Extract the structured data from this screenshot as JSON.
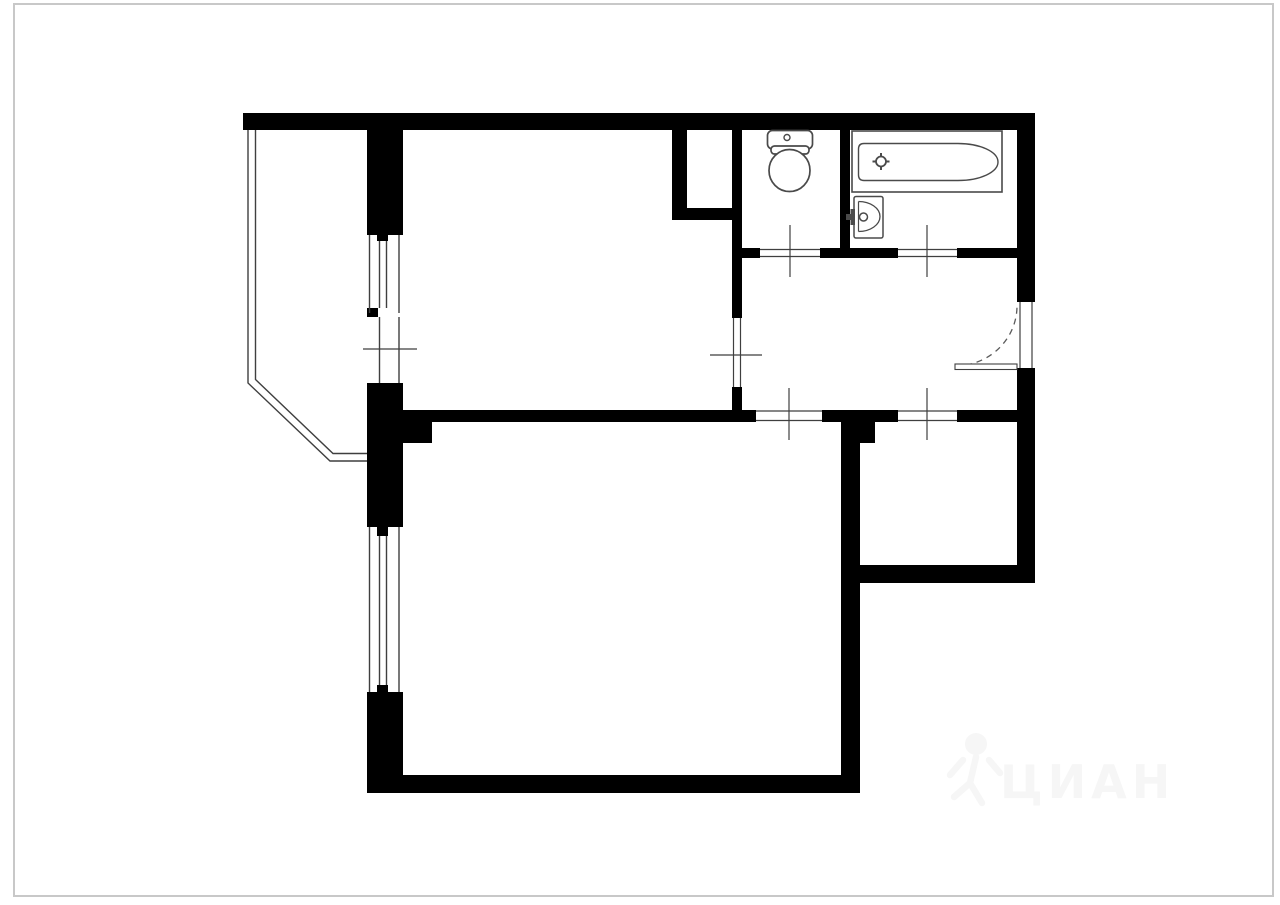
{
  "watermark": {
    "text": "ЦИАН",
    "color": "#f6f6f6"
  },
  "colors": {
    "wall": "#000000",
    "thin": "#3f3f3f",
    "fixture": "#4a4a4a",
    "arc": "#5a5a5a",
    "border": "#c8c8c8",
    "watermark": "#f6f6f6",
    "background": "#ffffff"
  },
  "plan": {
    "walls": [
      [
        243,
        113,
        792,
        17
      ],
      [
        1017,
        130,
        18,
        172
      ],
      [
        1017,
        368,
        18,
        215
      ],
      [
        841,
        565,
        194,
        18
      ],
      [
        841,
        412,
        34,
        31
      ],
      [
        841,
        443,
        19,
        350
      ],
      [
        367,
        775,
        493,
        18
      ],
      [
        367,
        129,
        36,
        106
      ],
      [
        367,
        383,
        36,
        144
      ],
      [
        367,
        692,
        36,
        101
      ],
      [
        377,
        235,
        11,
        6
      ],
      [
        367,
        308,
        11,
        9
      ],
      [
        377,
        527,
        11,
        9
      ],
      [
        377,
        685,
        11,
        8
      ],
      [
        403,
        412,
        29,
        31
      ],
      [
        403,
        410,
        353,
        12
      ],
      [
        822,
        410,
        76,
        12
      ],
      [
        957,
        410,
        78,
        12
      ],
      [
        732,
        130,
        10,
        188
      ],
      [
        732,
        387,
        10,
        35
      ],
      [
        672,
        130,
        15,
        90
      ],
      [
        672,
        208,
        70,
        12
      ],
      [
        840,
        130,
        10,
        128
      ],
      [
        732,
        248,
        28,
        10
      ],
      [
        820,
        248,
        78,
        10
      ],
      [
        957,
        248,
        60,
        10
      ]
    ],
    "opening_lines": [
      [
        760,
        249.5,
        820,
        249.5
      ],
      [
        760,
        256.5,
        820,
        256.5
      ],
      [
        898,
        249.5,
        957,
        249.5
      ],
      [
        898,
        256.5,
        957,
        256.5
      ],
      [
        756,
        411,
        822,
        411
      ],
      [
        756,
        420.5,
        822,
        420.5
      ],
      [
        898,
        411,
        957,
        411
      ],
      [
        898,
        420.5,
        957,
        420.5
      ],
      [
        733.5,
        318,
        733.5,
        387
      ],
      [
        740.5,
        318,
        740.5,
        387
      ],
      [
        1020,
        302,
        1020,
        368
      ],
      [
        1032,
        302,
        1032,
        368
      ],
      [
        790,
        225,
        790,
        277
      ],
      [
        927,
        225,
        927,
        277
      ],
      [
        789,
        388,
        789,
        440
      ],
      [
        927,
        388,
        927,
        440
      ],
      [
        710,
        355,
        762,
        355
      ],
      [
        363,
        349,
        417,
        349
      ]
    ],
    "window_lines": [
      [
        369.5,
        235,
        369.5,
        313
      ],
      [
        379.5,
        241,
        379.5,
        308
      ],
      [
        386.5,
        241,
        386.5,
        308
      ],
      [
        399,
        235,
        399,
        313
      ],
      [
        379.5,
        317,
        379.5,
        383
      ],
      [
        399,
        317,
        399,
        383
      ],
      [
        369.5,
        527,
        369.5,
        692
      ],
      [
        379.5,
        536,
        379.5,
        685
      ],
      [
        386.5,
        536,
        386.5,
        685
      ],
      [
        399,
        527,
        399,
        692
      ]
    ],
    "balcony": [
      "248,130 248,383 330,461 367,461",
      "255.5,130 255.5,379.5 333,453.5 367,453.5"
    ],
    "shapes": [
      {
        "layer": "frame-border",
        "type": "rect",
        "x": 14,
        "y": 4,
        "w": 1259,
        "h": 892,
        "fill": "none",
        "stroke": "border",
        "sw": 2
      },
      {
        "layer": "entry-door",
        "type": "path",
        "d": "M 955 366 A 62 60 0 0 0 1017 306",
        "fill": "none",
        "stroke": "arc",
        "sw": 1.3,
        "dash": "6 5"
      },
      {
        "layer": "entry-door",
        "type": "rect",
        "x": 955,
        "y": 364,
        "w": 62,
        "h": 5.5,
        "fill": "#ffffff",
        "stroke": "thin",
        "sw": 1.1
      },
      {
        "layer": "toilet-icon",
        "type": "rect",
        "x": 767.5,
        "y": 130.5,
        "w": 45,
        "h": 18.5,
        "rx": 5,
        "fill": "#ffffff",
        "stroke": "fixture",
        "sw": 1.7
      },
      {
        "layer": "toilet-icon",
        "type": "circle",
        "cx": 787,
        "cy": 137.5,
        "r": 3,
        "fill": "#ffffff",
        "stroke": "fixture",
        "sw": 1.4
      },
      {
        "layer": "toilet-icon",
        "type": "rect",
        "x": 771,
        "y": 146,
        "w": 38,
        "h": 8,
        "rx": 3.5,
        "fill": "#ffffff",
        "stroke": "fixture",
        "sw": 1.7
      },
      {
        "layer": "toilet-icon",
        "type": "ellipse",
        "cx": 789.5,
        "cy": 170.5,
        "rx": 20.5,
        "ry": 21,
        "fill": "#ffffff",
        "stroke": "fixture",
        "sw": 1.7
      },
      {
        "layer": "bathtub-icon",
        "type": "rect",
        "x": 852,
        "y": 131,
        "w": 150,
        "h": 61,
        "fill": "#ffffff",
        "stroke": "fixture",
        "sw": 1.6
      },
      {
        "layer": "bathtub-icon",
        "type": "path",
        "d": "M 864 143.5 H 958 A 40 18.5 0 0 1 958 180.5 H 864 Q 858.5 180.5 858.5 175 V 149 Q 858.5 143.5 864 143.5 Z",
        "fill": "#ffffff",
        "stroke": "fixture",
        "sw": 1.4
      },
      {
        "layer": "bathtub-icon",
        "type": "circle",
        "cx": 881,
        "cy": 161.5,
        "r": 5,
        "fill": "#ffffff",
        "stroke": "fixture",
        "sw": 1.8
      },
      {
        "layer": "bathtub-icon",
        "type": "line",
        "x1": 881,
        "y1": 153,
        "x2": 881,
        "y2": 157,
        "stroke": "fixture",
        "sw": 2
      },
      {
        "layer": "bathtub-icon",
        "type": "line",
        "x1": 881,
        "y1": 166,
        "x2": 881,
        "y2": 170,
        "stroke": "fixture",
        "sw": 2
      },
      {
        "layer": "bathtub-icon",
        "type": "line",
        "x1": 872.5,
        "y1": 161.5,
        "x2": 876.5,
        "y2": 161.5,
        "stroke": "fixture",
        "sw": 2
      },
      {
        "layer": "bathtub-icon",
        "type": "line",
        "x1": 885.5,
        "y1": 161.5,
        "x2": 889.5,
        "y2": 161.5,
        "stroke": "fixture",
        "sw": 2
      },
      {
        "layer": "sink-icon",
        "type": "rect",
        "x": 854,
        "y": 196.5,
        "w": 29,
        "h": 41.5,
        "rx": 2,
        "fill": "#ffffff",
        "stroke": "fixture",
        "sw": 1.5
      },
      {
        "layer": "sink-icon",
        "type": "path",
        "d": "M 858.5 201.5 A 21.5 15 0 0 1 858.5 231.5",
        "fill": "none",
        "stroke": "fixture",
        "sw": 1.3
      },
      {
        "layer": "sink-icon",
        "type": "line",
        "x1": 858.5,
        "y1": 201.5,
        "x2": 858.5,
        "y2": 231.5,
        "stroke": "fixture",
        "sw": 1.2
      },
      {
        "layer": "sink-icon",
        "type": "rect",
        "x": 846,
        "y": 214,
        "w": 7,
        "h": 6,
        "fill": "fixture",
        "stroke": "none",
        "sw": 0
      },
      {
        "layer": "sink-icon",
        "type": "rect",
        "x": 850.5,
        "y": 209,
        "w": 4.5,
        "h": 16,
        "fill": "fixture",
        "stroke": "none",
        "sw": 0
      },
      {
        "layer": "sink-icon",
        "type": "circle",
        "cx": 863.5,
        "cy": 217,
        "r": 4,
        "fill": "#ffffff",
        "stroke": "fixture",
        "sw": 1.5
      },
      {
        "layer": "watermark-figure",
        "type": "circle",
        "cx": 976,
        "cy": 744,
        "r": 11,
        "fill": "watermark",
        "stroke": "none",
        "sw": 0
      },
      {
        "layer": "watermark-figure",
        "type": "path",
        "d": "M 950 775 L 963 760 M 1000 773 L 989 760 M 976 757 L 970 783 M 970 783 L 954 797 M 970 783 L 982 803",
        "fill": "none",
        "stroke": "watermark",
        "sw": 6.5,
        "cap": "round"
      }
    ]
  }
}
